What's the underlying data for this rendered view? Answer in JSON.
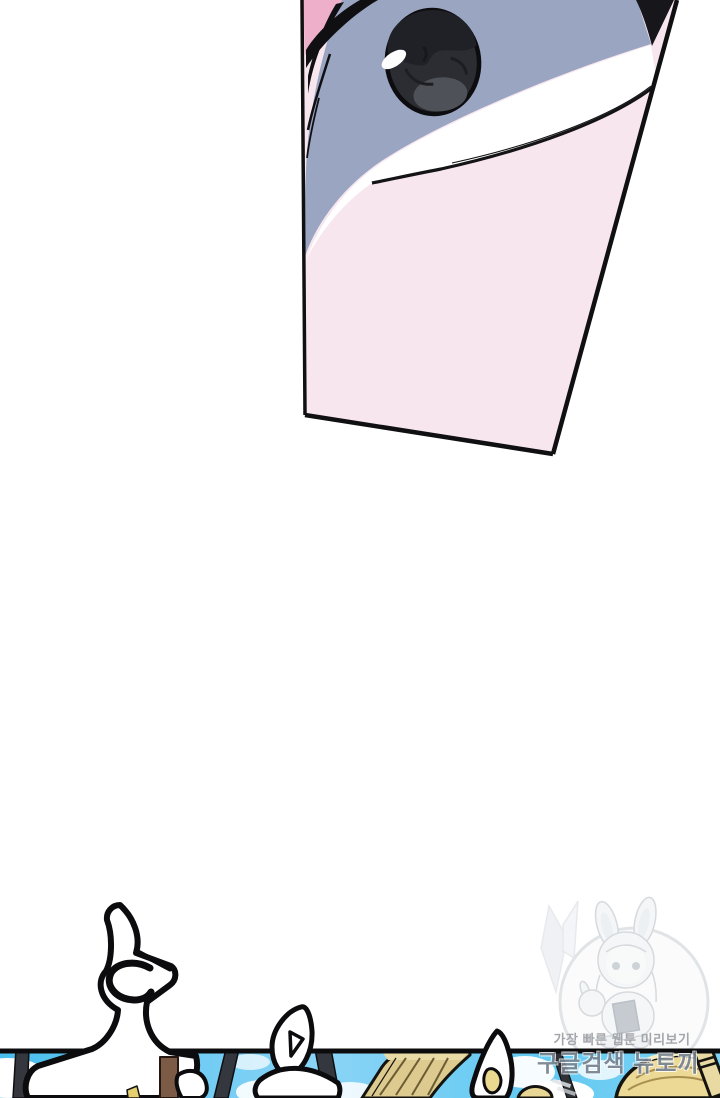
{
  "page": {
    "type": "webtoon-viewer-page",
    "width_px": 720,
    "height_px": 1098,
    "background": "#ffffff"
  },
  "watermark": {
    "line1": "가장 빠른 웹툰 미리보기",
    "line2": "구글검색 뉴토끼",
    "mascot": "bunny-hood-chibi-girl-with-moon",
    "text_color_line1": "#a3a6ab",
    "text_color_line2": "#68758496"
  },
  "panels": [
    {
      "name": "eye-closeup-panel",
      "description": "slanted panel, extreme close-up of a single dark eye on pale pink skin with blue-gray lid shadow and black lashes",
      "corners": [
        [
          302,
          0
        ],
        [
          677,
          0
        ],
        [
          553,
          454
        ],
        [
          305,
          415
        ]
      ]
    },
    {
      "name": "bottom-sky-panel",
      "description": "full-width strip cut by page bottom: blue sky, clouds, poles, tan shapes, large white sound-effect lettering crossing the border",
      "top_edge_y": 1051
    }
  ],
  "colors": {
    "page_bg": "#ffffff",
    "skin": "#f8e6ef",
    "skin_deep": "#edafc9",
    "band": "#9aa5c2",
    "iris": "#2c2d33",
    "iris_dark_top": "#202127",
    "iris_light_bottom": "#4e5157",
    "ink": "#101013",
    "sky_left": "#49bfee",
    "sky_mid": "#8ad4f6",
    "sky_right": "#62c9f1",
    "tan": "#ddca8e",
    "sack": "#ecd995",
    "pole_dark": "#34383e",
    "pole_brown": "#7b5a46",
    "pole_ring": "#e9d9a2",
    "wm_gray": "#a3a6ab",
    "wm_slate": "rgba(104,117,132,0.9)"
  }
}
